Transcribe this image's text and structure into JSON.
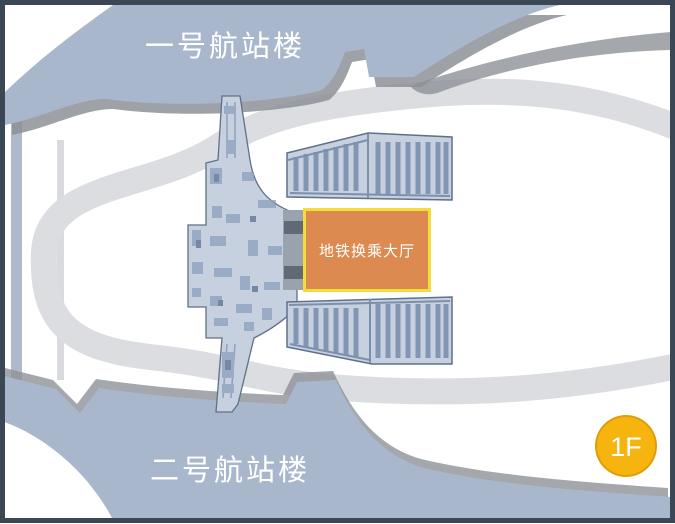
{
  "map": {
    "terminal1_label": "一号航站楼",
    "terminal2_label": "二号航站楼",
    "metro_hall_label": "地铁换乘大厅",
    "floor_badge_label": "1F"
  },
  "colors": {
    "frame_border": "#3b4754",
    "background": "#ffffff",
    "terminal_fill": "#a9b7cd",
    "shadow": "#8d9197",
    "road": "#dcdde0",
    "corridor_stripe": "#aebacb",
    "side_road_stripe": "#d8dadd",
    "floorplan_fill": "#c6d0df",
    "floorplan_line": "#5f7089",
    "floorplan_detail": "#8ca0bd",
    "parking_strip": "#8296b4",
    "wall_gray": "#9aa3ad",
    "wall_dark": "#606a76",
    "metro_hall_fill": "#dd8a50",
    "metro_hall_border": "#f2de3a",
    "badge_fill": "#f6b40e",
    "badge_border": "#e09d08",
    "label_text": "#ffffff"
  }
}
